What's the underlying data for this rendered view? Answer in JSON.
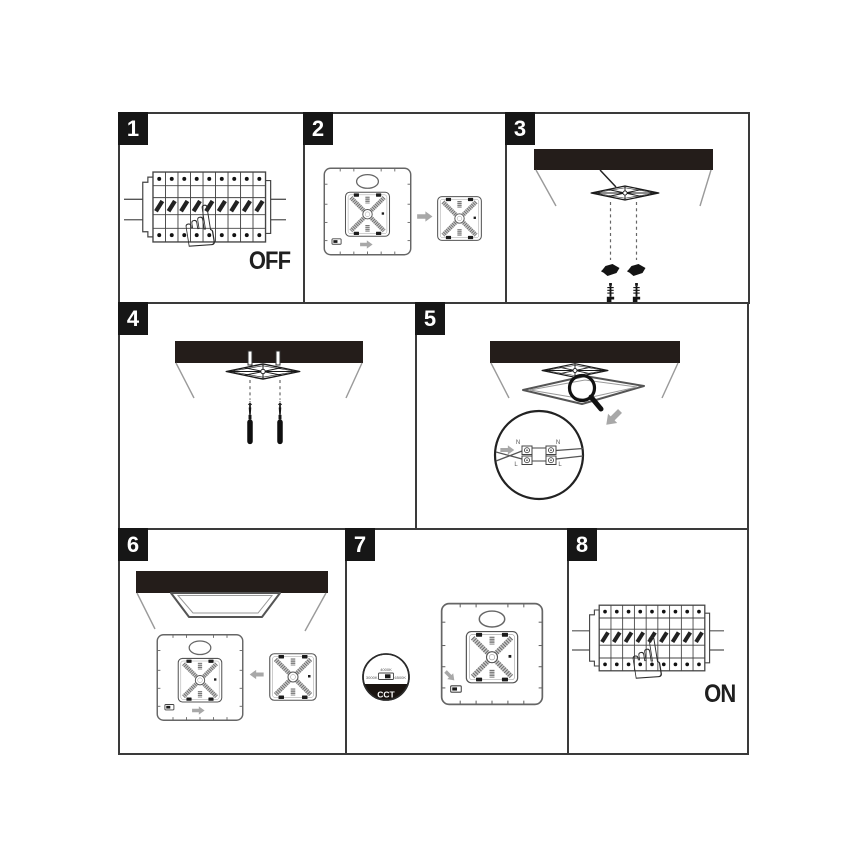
{
  "colors": {
    "panel_border": "#3a3a3a",
    "badge_background": "#161616",
    "ceiling": "#241d1a",
    "arrow_gray": "#a8a8a8",
    "line_art": "#444444"
  },
  "icons": {
    "pointing_hand": "☝"
  },
  "steps": [
    {
      "number": "1",
      "caption": "OFF"
    },
    {
      "number": "2"
    },
    {
      "number": "3"
    },
    {
      "number": "4"
    },
    {
      "number": "5",
      "terminal_labels": {
        "n_left": "N",
        "n_right": "N",
        "l_left": "L",
        "l_right": "L"
      }
    },
    {
      "number": "6"
    },
    {
      "number": "7",
      "cct": {
        "badge": "CCT",
        "top": "4000K",
        "left": "3000K",
        "right": "6500K"
      }
    },
    {
      "number": "8",
      "caption": "ON"
    }
  ]
}
